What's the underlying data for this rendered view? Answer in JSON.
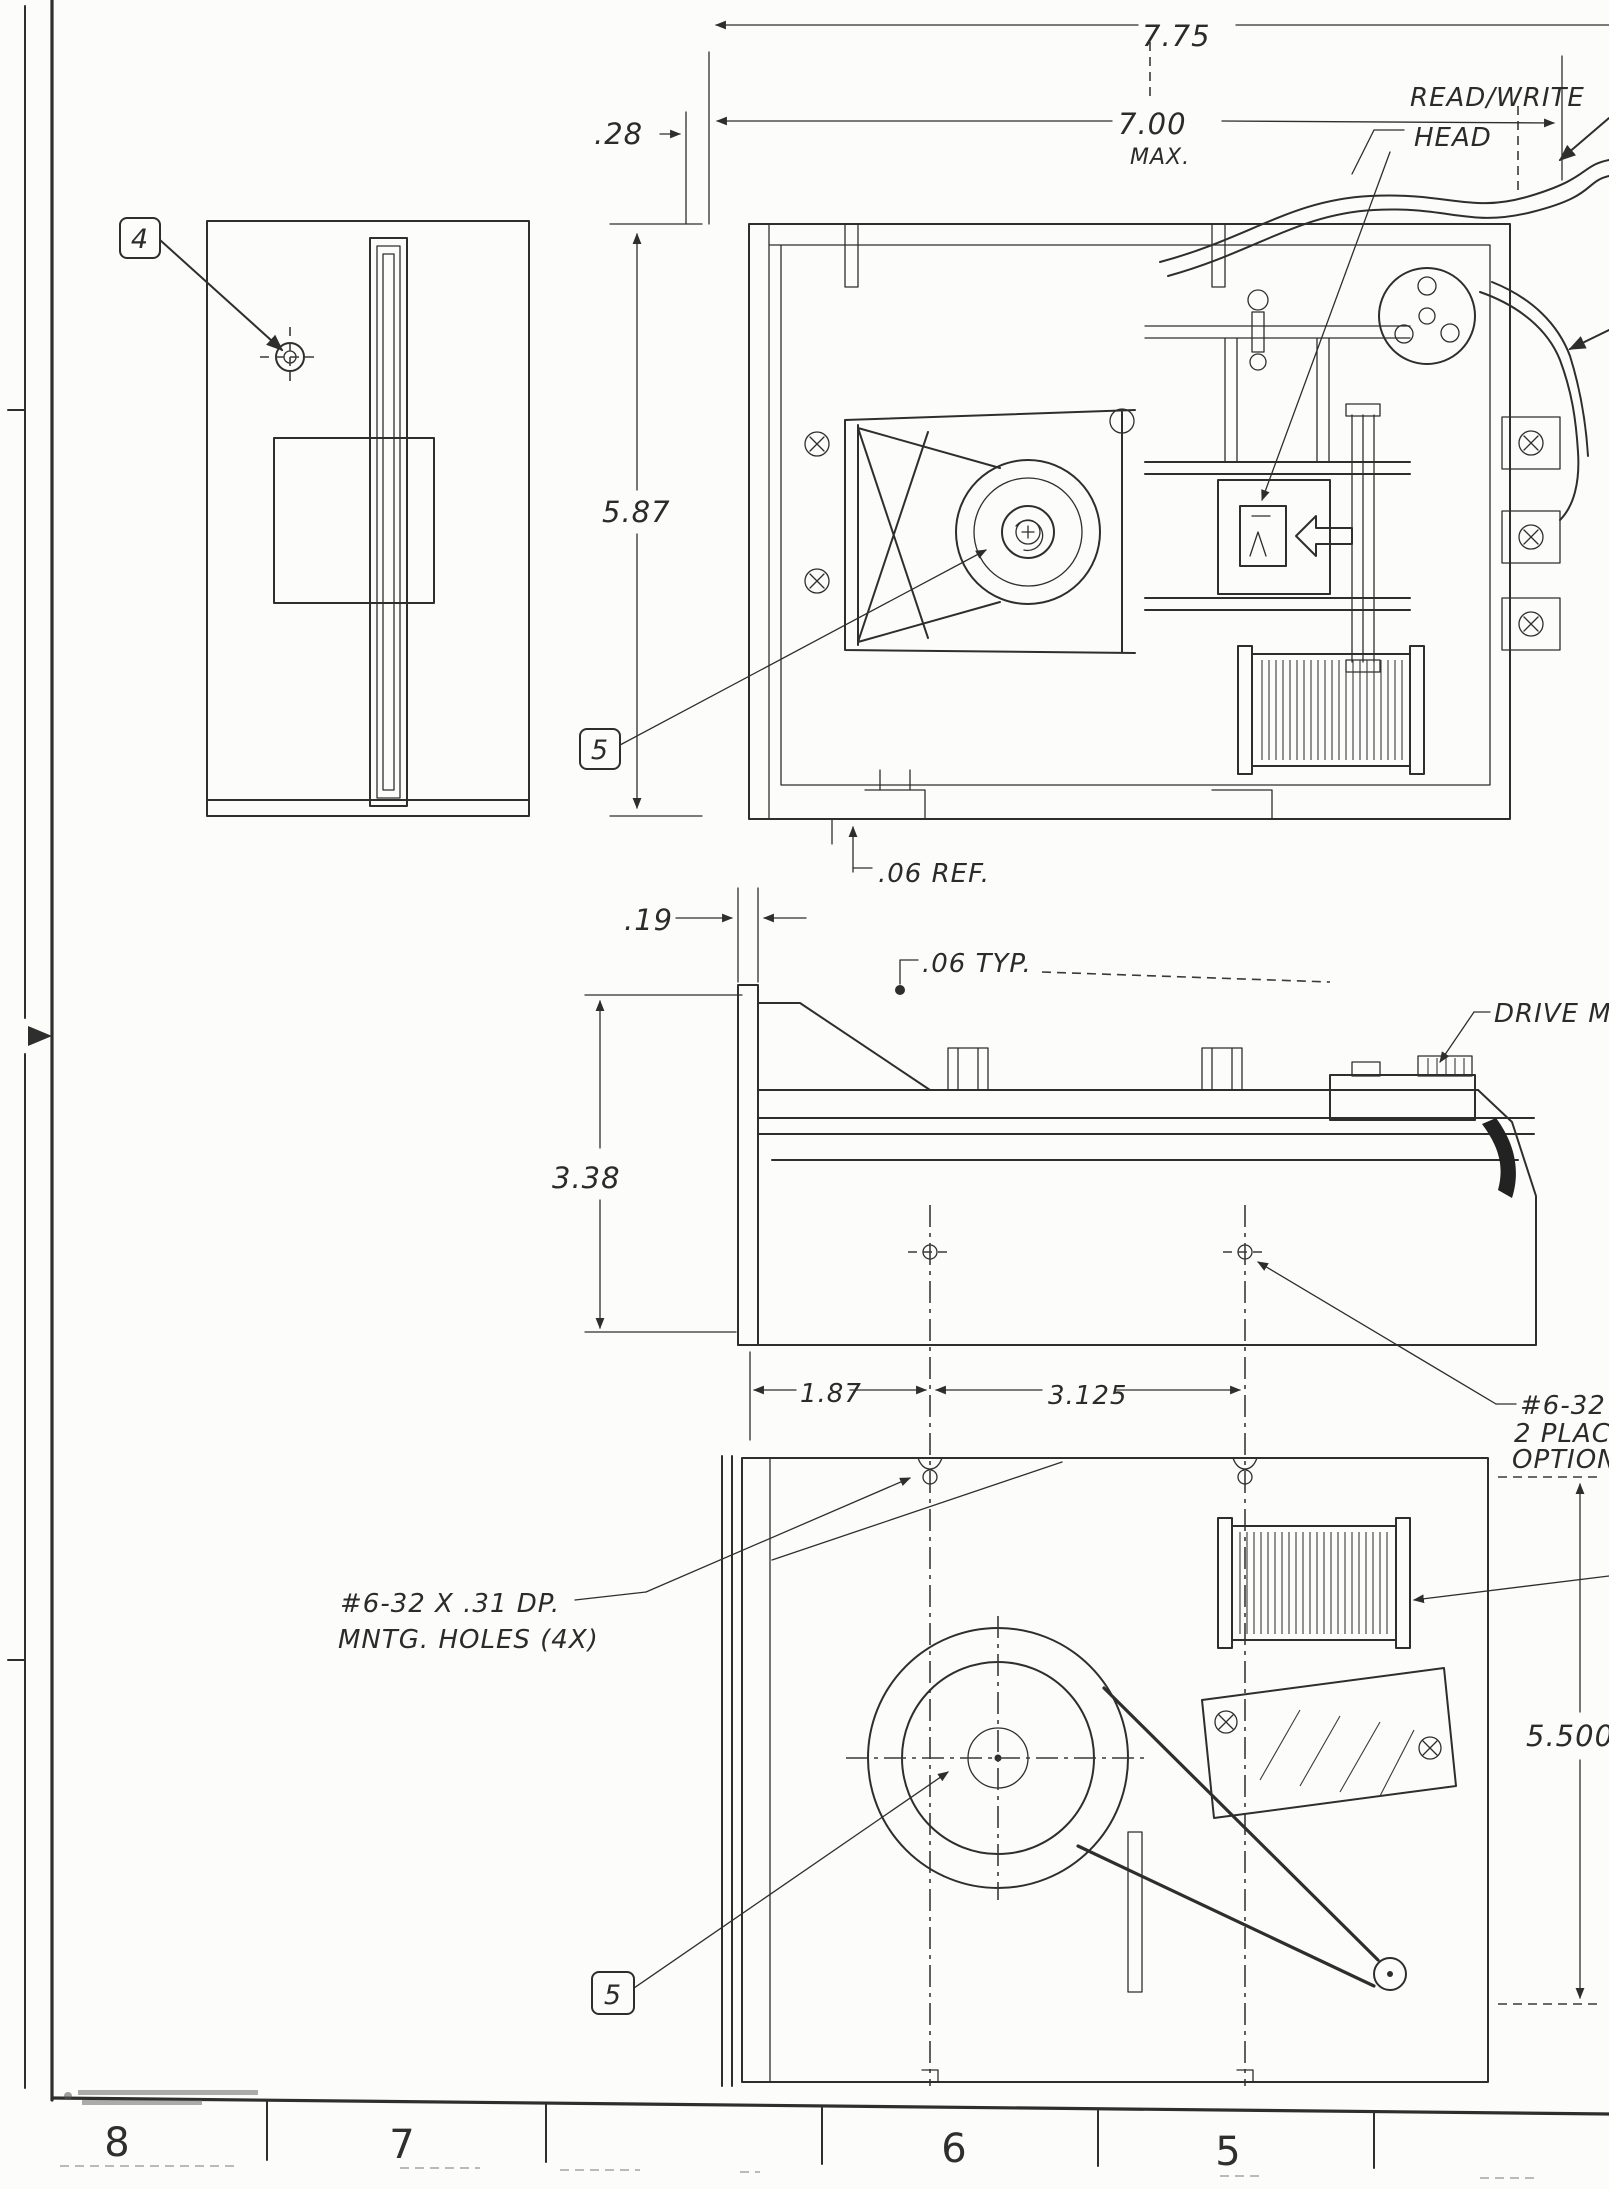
{
  "drawing": {
    "dimensions": {
      "d_775": "7.75",
      "d_700": "7.00",
      "d_700_suffix": "MAX.",
      "d_28": ".28",
      "d_587": "5.87",
      "d_06ref": ".06 REF.",
      "d_19": ".19",
      "d_06typ": ".06 TYP.",
      "d_338": "3.38",
      "d_187": "1.87",
      "d_3125": "3.125",
      "d_5500": "5.500"
    },
    "callouts": {
      "read_write_head_line1": "READ/WRITE",
      "read_write_head_line2": "HEAD",
      "drive_motor": "DRIVE M",
      "tap_line1": "#6-32 T",
      "tap_line2": "2 PLACE",
      "tap_line3": "OPTION",
      "mntg_line1": "#6-32 X .31 DP.",
      "mntg_line2": "MNTG. HOLES  (4X)"
    },
    "balloons": {
      "item4": "4",
      "item5_top": "5",
      "item5_bottom": "5"
    },
    "border_zones": [
      "8",
      "7",
      "6",
      "5"
    ]
  }
}
